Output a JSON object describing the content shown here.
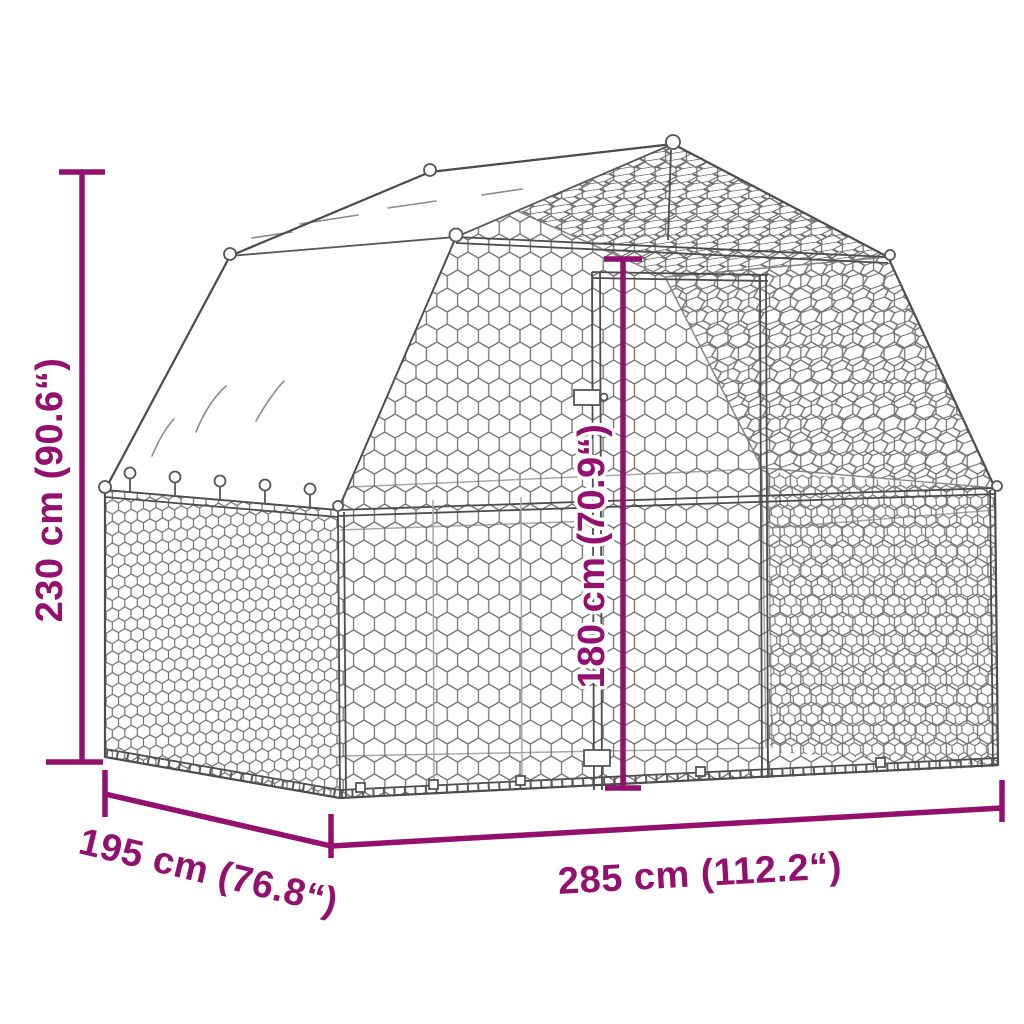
{
  "diagram": {
    "subject": "chicken-run-with-barn-roof-and-tarp",
    "dimensions": {
      "height": {
        "label": "230 cm (90.6“)"
      },
      "door_height": {
        "label": "180 cm (70.9“)"
      },
      "depth": {
        "label": "195 cm (76.8“)"
      },
      "width": {
        "label": "285 cm (112.2“)"
      }
    },
    "colors": {
      "dimension_accent": "#93106E",
      "structure_line": "#4d4d4d",
      "mesh_line": "#737373",
      "background": "#ffffff"
    }
  }
}
